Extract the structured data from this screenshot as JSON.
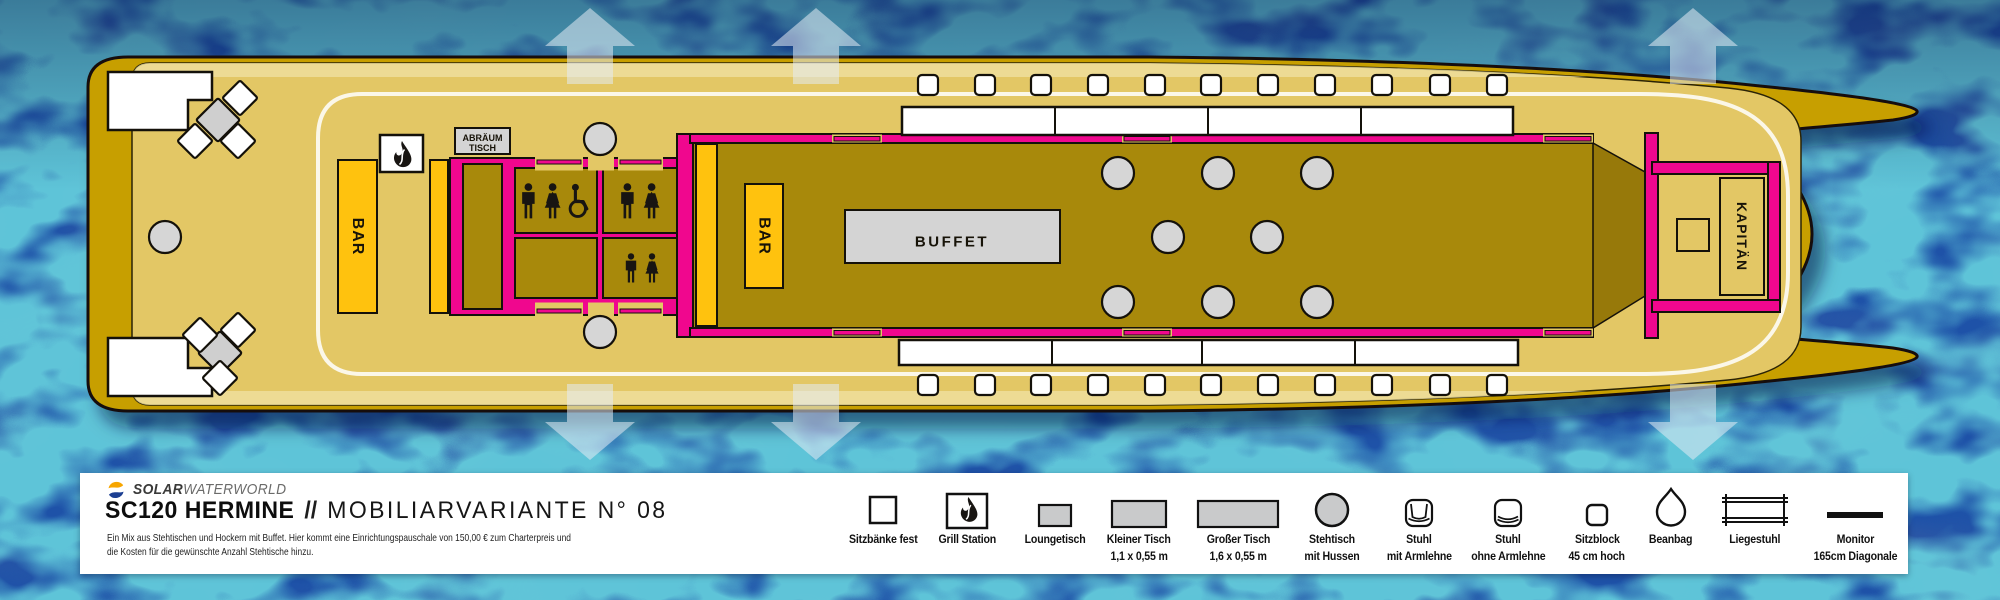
{
  "header": {
    "brand_bold": "SOLAR",
    "brand_light": "WATERWORLD",
    "title_model": "SC120 HERMINE",
    "title_sep": "//",
    "title_variant": "MOBILIARVARIANTE N° 08",
    "desc_line1": "Ein Mix aus Stehtischen und Hockern mit Buffet. Hier kommt eine Einrichtungspauschale von 150,00 € zum Charterpreis und",
    "desc_line2": "die Kosten für die gewünschte Anzahl Stehtische hinzu."
  },
  "plan": {
    "labels": {
      "bar": "BAR",
      "buffet": "BUFFET",
      "kapitaen": "KAPITÄN",
      "abraeum_line1": "ABRÄUM",
      "abraeum_line2": "TISCH"
    },
    "circles": [
      [
        165,
        237
      ],
      [
        600,
        139
      ],
      [
        600,
        332
      ],
      [
        1118,
        173
      ],
      [
        1218,
        173
      ],
      [
        1317,
        173
      ],
      [
        1168,
        237
      ],
      [
        1267,
        237
      ],
      [
        1118,
        302
      ],
      [
        1218,
        302
      ],
      [
        1317,
        302
      ]
    ],
    "white_diamonds": [
      [
        240,
        98
      ],
      [
        195,
        141
      ],
      [
        238,
        141
      ],
      [
        200,
        335
      ],
      [
        238,
        330
      ],
      [
        220,
        378
      ]
    ],
    "gray_diamonds": [
      [
        218,
        120
      ],
      [
        220,
        353
      ]
    ],
    "bench_xs": [
      918,
      975,
      1031,
      1088,
      1145,
      1201,
      1258,
      1315,
      1372,
      1430,
      1487
    ],
    "bench_rows": [
      75,
      375
    ],
    "gangway_arrows_up_x": [
      590,
      816,
      1693
    ],
    "gangway_arrows_down_x": [
      590,
      816,
      1693
    ]
  },
  "legend": {
    "items": [
      {
        "icon": "bench-square",
        "label": "Sitzbänke fest",
        "x": 883
      },
      {
        "icon": "grill-flame",
        "label": "Grill Station",
        "x": 967
      },
      {
        "icon": "lounge-table",
        "label": "Loungetisch",
        "x": 1055
      },
      {
        "icon": "small-table",
        "label": "Kleiner Tisch",
        "label2": "1,1 x 0,55 m",
        "x": 1139
      },
      {
        "icon": "large-table",
        "label": "Großer Tisch",
        "label2": "1,6 x 0,55 m",
        "x": 1238
      },
      {
        "icon": "standing-table",
        "label": "Stehtisch",
        "label2": "mit Hussen",
        "x": 1332
      },
      {
        "icon": "chair-arms",
        "label": "Stuhl",
        "label2": "mit Armlehne",
        "x": 1419
      },
      {
        "icon": "chair-noarms",
        "label": "Stuhl",
        "label2": "ohne Armlehne",
        "x": 1508
      },
      {
        "icon": "seat-block",
        "label": "Sitzblock",
        "label2": "45 cm hoch",
        "x": 1597
      },
      {
        "icon": "beanbag",
        "label": "Beanbag",
        "x": 1671
      },
      {
        "icon": "deck-chair",
        "label": "Liegestuhl",
        "x": 1755
      },
      {
        "icon": "monitor",
        "label": "Monitor",
        "label2": "165cm Diagonale",
        "x": 1855
      }
    ]
  },
  "colors": {
    "water": "#1E52A8",
    "hull": "#C79F06",
    "deck": "#E3C765",
    "salon": "#A8890B",
    "salon-dark": "#97790A",
    "magenta": "#F0078E",
    "orange": "#FFC20E",
    "item-gray": "#D6D6D6",
    "legend-gray": "#C9CACB",
    "logo-blue": "#1C3F92",
    "logo-yellow": "#F7A600"
  }
}
